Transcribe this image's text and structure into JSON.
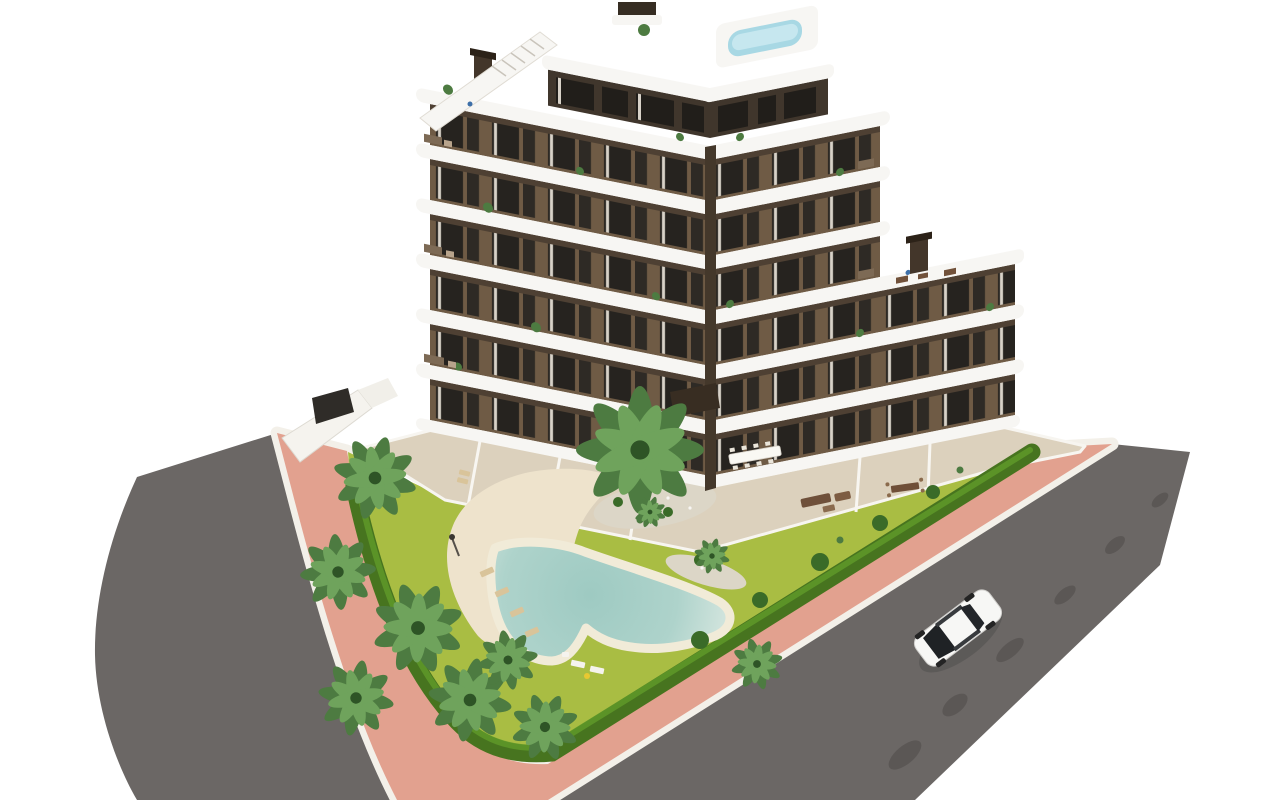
{
  "scene": {
    "type": "aerial-3d-architectural-render",
    "description": "Bird's-eye architectural visualization of a modern V-shaped apartment residence with dark-brown facades wrapped by curved white balconies, a rooftop terrace with plunge pool and stair bulkhead, landscaped garden with free-form lagoon swimming pool, sand beach, sun loungers and palm trees, enclosed by a perimeter hedge, salmon-pink sidewalk, two asphalt streets and a single white car.",
    "building": {
      "wings": 2,
      "floors_visible": 7,
      "facade": "dark brown render with tall windows and white curtains",
      "balconies": "white curved wrap-around slabs with rounded ends",
      "rooftop_features": [
        "roof terrace",
        "plunge pool",
        "stair bulkhead",
        "elevator tower",
        "chimneys",
        "planters"
      ],
      "ground_floor": "private terraces with dining tables and lounge furniture"
    },
    "garden": {
      "lawn": true,
      "palm_trees": 11,
      "bushes": 8,
      "perimeter_hedge": true,
      "pool": "free-form lagoon pool with sand beach edge",
      "sun_loungers": 6,
      "gravel_islands": 3,
      "street_lamp": 1
    },
    "streets": {
      "roads": 2,
      "surface": "asphalt",
      "sidewalk": "salmon-pink pavement with white curbs",
      "tree_shadows_on_road": true,
      "vehicles": [
        {
          "type": "sedan",
          "color": "white",
          "heading": "northeast"
        }
      ]
    },
    "people_visible": 2
  },
  "colors": {
    "background": "#ffffff",
    "road": "#6b6765",
    "roadShadow": "#4f4b49",
    "sidewalk": "#e2a18f",
    "curb": "#f3f0e9",
    "lawn": "#a9bd43",
    "hedge": "#47741f",
    "hedgeLight": "#609b29",
    "sand": "#eee3cc",
    "gravel": "#dcd6c7",
    "poolRim": "#f1ebd8",
    "poolDeep": "#9ecac2",
    "poolMid": "#aed3cb",
    "poolEdge": "#cfe3dc",
    "palmDark": "#4d7b41",
    "palmLight": "#6fa35c",
    "palmCore": "#2e5426",
    "bush": "#3a6b28",
    "facade": "#6f5b45",
    "facadeShadow": "#4e4033",
    "window": "#26231f",
    "windowNarrow": "#2e2a25",
    "curtain": "#d8d2c8",
    "penthouseWall": "#40362c",
    "penthouseGlass": "#211e1a",
    "band": "#f7f6f3",
    "seam": "#44382b",
    "chimney": "#43362a",
    "chimneyCap": "#2c2218",
    "terrace": "#dcd1bd",
    "terraceWall": "#f7f5f0",
    "roofPool": "#a8d8e4",
    "roofPoolLight": "#c6e7ef",
    "towerDark": "#362d23",
    "carBody": "#f7f7f5",
    "carGlass": "#1f2225",
    "carTrim": "#383b3e",
    "loungerTan": "#d9c49a",
    "loungerWhite": "#f5f3ee",
    "towelYellow": "#e8c832",
    "furnBrown": "#71513a",
    "pergola": "#382d22",
    "wallWhite": "#f5f3ee",
    "personBlue": "#3d6fa8"
  }
}
